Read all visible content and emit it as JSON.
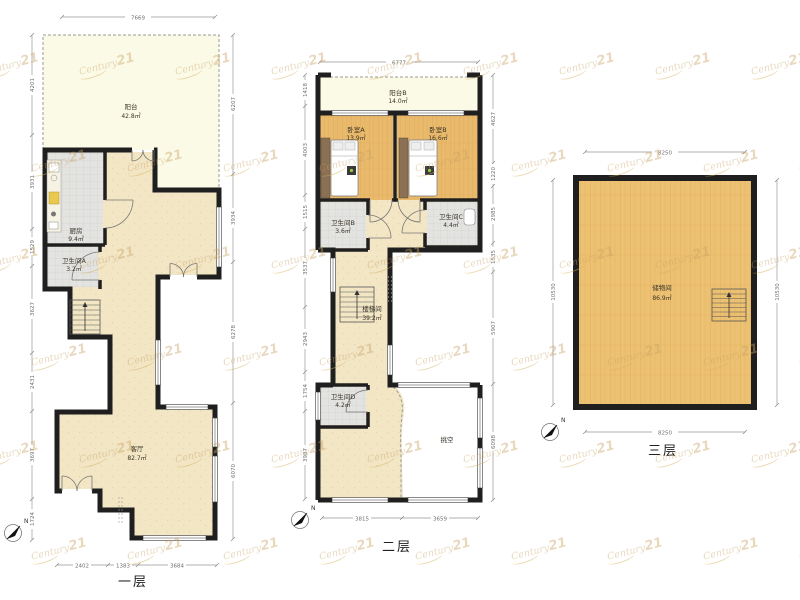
{
  "brand_watermark": {
    "script": "Century",
    "number": "21",
    "color": "#c7a364"
  },
  "compass": {
    "label": "N"
  },
  "colors": {
    "wall": "#1f1f1f",
    "living_fill": "#f2e6c5",
    "balcony_fill": "#fbfae7",
    "tile_fill": "#e3e3e1",
    "wood_fill": "#eaba6c",
    "dimension_line": "#999999"
  },
  "floors": [
    {
      "title": "一层",
      "rooms": [
        {
          "label": "阳台",
          "area": "42.8㎡"
        },
        {
          "label": "厨房",
          "area": "9.4㎡"
        },
        {
          "label": "卫生间A",
          "area": "3.2㎡"
        },
        {
          "label": "客厅",
          "area": "82.7㎡"
        }
      ],
      "dims": {
        "top": [
          "7669"
        ],
        "bottom": [
          "2402",
          "1383",
          "3684"
        ],
        "left": [
          "4201",
          "3931",
          "1529",
          "3627",
          "2431",
          "3697",
          "1724"
        ],
        "right": [
          "6207",
          "3934",
          "6278",
          "6070"
        ]
      }
    },
    {
      "title": "二层",
      "rooms": [
        {
          "label": "阳台B",
          "area": "14.0㎡"
        },
        {
          "label": "卧室A",
          "area": "13.9㎡"
        },
        {
          "label": "卧室B",
          "area": "16.6㎡"
        },
        {
          "label": "卫生间B",
          "area": "3.6㎡"
        },
        {
          "label": "卫生间C",
          "area": "4.4㎡"
        },
        {
          "label": "楼梯间",
          "area": "39.2㎡"
        },
        {
          "label": "卫生间D",
          "area": "4.2㎡"
        },
        {
          "label": "挑空",
          "area": ""
        }
      ],
      "dims": {
        "top": [
          "6777"
        ],
        "bottom": [
          "3815",
          "3659"
        ],
        "left": [
          "1418",
          "4003",
          "1515",
          "3537",
          "2943",
          "1754",
          "3987"
        ],
        "right": [
          "4627",
          "1220",
          "2985",
          "1535",
          "5907",
          "6098"
        ]
      }
    },
    {
      "title": "三层",
      "rooms": [
        {
          "label": "储物间",
          "area": "86.9㎡"
        }
      ],
      "dims": {
        "top": [
          "8250"
        ],
        "bottom": [
          "8250"
        ],
        "left": [
          "10530"
        ],
        "right": [
          "10530"
        ]
      }
    }
  ]
}
